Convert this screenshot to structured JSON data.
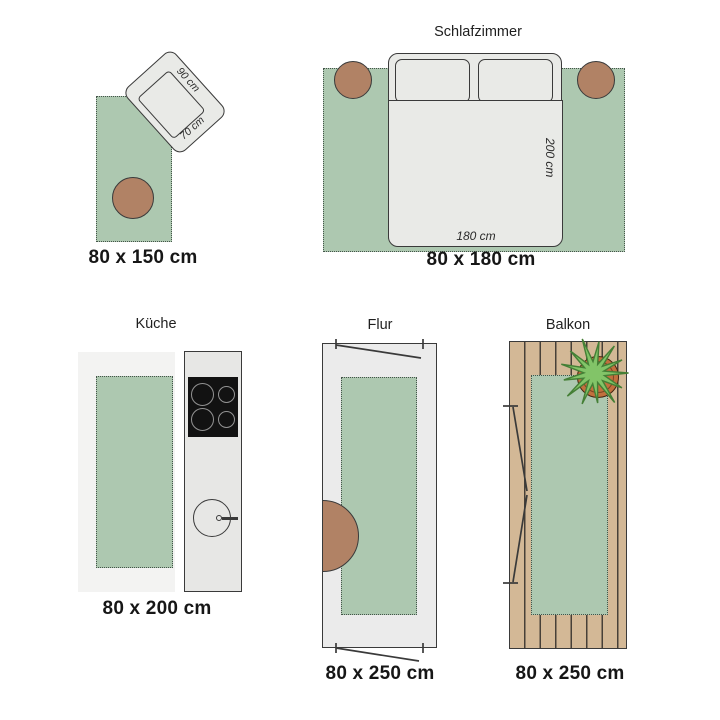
{
  "panels": {
    "living": {
      "size_label": "80 x 150 cm",
      "chair_depth_label": "90 cm",
      "chair_width_label": "70 cm"
    },
    "bedroom": {
      "title": "Schlafzimmer",
      "size_label": "80 x 180 cm",
      "bed_width_label": "180 cm",
      "bed_length_label": "200 cm"
    },
    "kitchen": {
      "title": "Küche",
      "size_label": "80 x 200 cm"
    },
    "hallway": {
      "title": "Flur",
      "size_label": "80 x 250 cm"
    },
    "balcony": {
      "title": "Balkon",
      "size_label": "80 x 250 cm"
    }
  },
  "icons": {
    "armchair-icon": "rotated rounded rectangle with inner seat",
    "stool-icon": "brown filled circle",
    "bed-icon": "rounded rectangle with two pillows and duvet",
    "cooktop-icon": "black rectangle with four burner rings",
    "sink-icon": "circle with drain dot and faucet bar",
    "door-swing-icon": "thin diagonal lines with tick marks",
    "plant-icon": "green starburst over terracotta pot circle",
    "deck-planks-icon": "vertical plank stripes"
  },
  "colors": {
    "rug": "#adc8b0",
    "rug_border": "#44544a",
    "outline": "#3a3a3a",
    "furniture": "#e9eae7",
    "stool": "#b18265",
    "floor": "#f3f3f2",
    "hall": "#ebebeb",
    "counter": "#e7e7e5",
    "cooktop": "#121212",
    "burner": "#939393",
    "wood": "#d3b896",
    "plank": "#474038",
    "pot": "#c1703e",
    "pot_border": "#42230f",
    "plant": "#82c468",
    "plant_border": "#457f36",
    "ink": "#1f1f1f",
    "label_ink": "#161616"
  }
}
